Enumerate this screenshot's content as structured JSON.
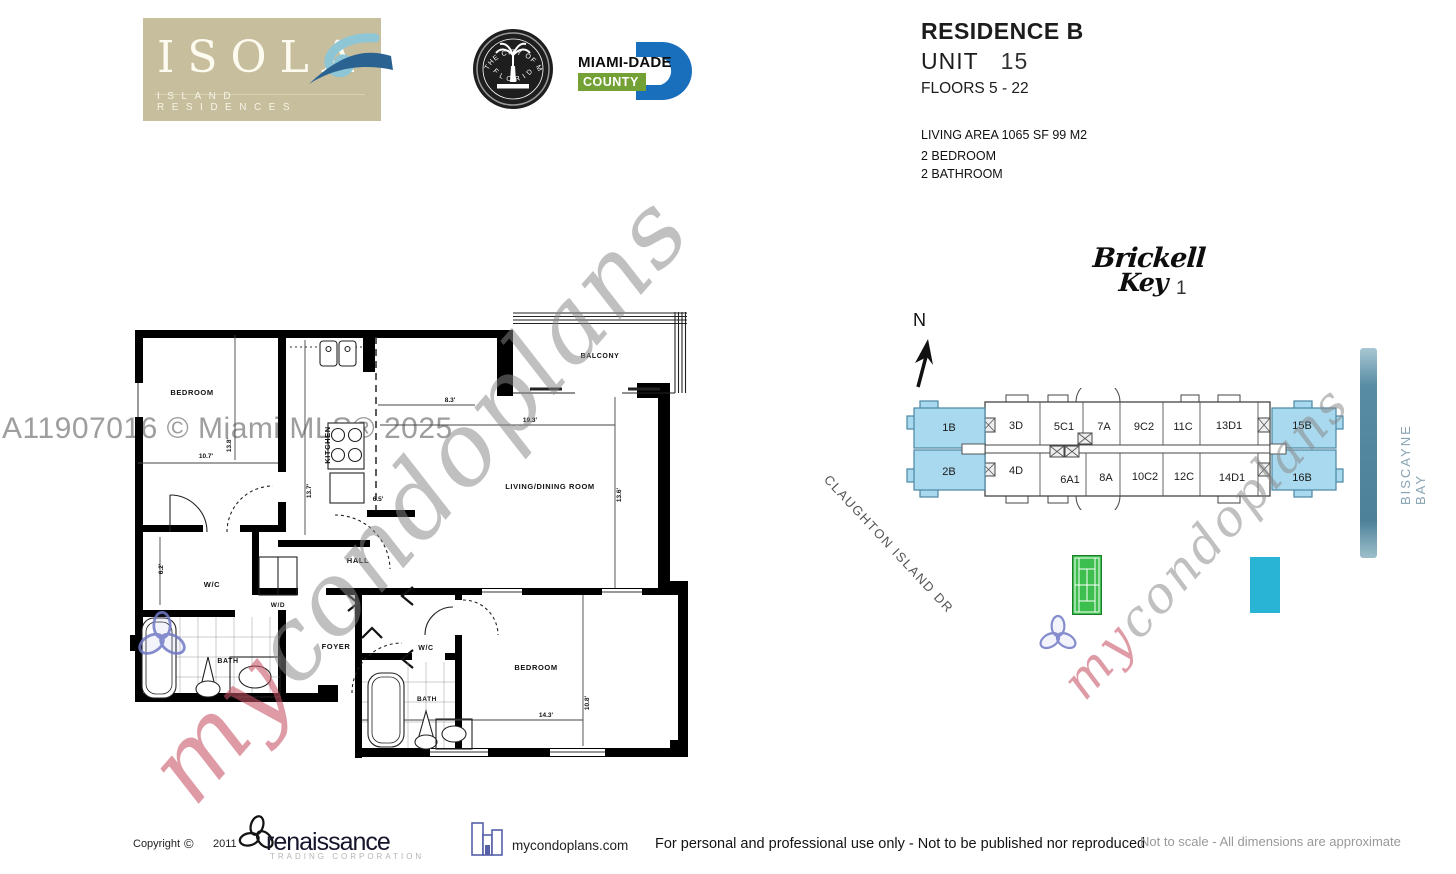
{
  "header": {
    "isola": {
      "name": "ISOLA",
      "subtitle": "ISLAND RESIDENCES"
    },
    "seal": {
      "top": "THE CITY OF MIAMI",
      "bottom": "FLORIDA"
    },
    "county": {
      "name": "MIAMI-DADE",
      "sub": "COUNTY"
    }
  },
  "title_block": {
    "residence": "RESIDENCE B",
    "unit_label": "UNIT",
    "unit_number": "15",
    "floors": "FLOORS 5 - 22",
    "living_area": "LIVING AREA 1065 SF 99 M2",
    "bedrooms": "2 BEDROOM",
    "bathrooms": "2 BATHROOM"
  },
  "brickell": {
    "line1": "Brickell",
    "line2": "Key",
    "number": "1"
  },
  "site_plan": {
    "north": "N",
    "street": "CLAUGHTON ISLAND DR",
    "bay": "BISCAYNE BAY",
    "units_top": [
      "1B",
      "3D",
      "5C1",
      "7A",
      "9C2",
      "11C",
      "13D1",
      "15B"
    ],
    "units_bottom": [
      "2B",
      "4D",
      "6A1",
      "8A",
      "10C2",
      "12C",
      "14D1",
      "16B"
    ],
    "highlight_color": "#a9d9ee",
    "tennis_color": "#3cbf4e",
    "pool_color": "#29b4d6"
  },
  "floor_plan": {
    "rooms": {
      "bedroom1": "BEDROOM",
      "kitchen": "KITCHEN",
      "living": "LIVING/DINING ROOM",
      "balcony": "BALCONY",
      "hall": "HALL",
      "wc1": "W/C",
      "wd": "W/D",
      "bath1": "BATH",
      "foyer": "FOYER",
      "wc2": "W/C",
      "bath2": "BATH",
      "bedroom2": "BEDROOM"
    },
    "dims": {
      "bed1_w": "10.7'",
      "bed1_h": "13.8'",
      "kitchen_h": "13.7'",
      "kitchen_w": "6.5'",
      "balcony_door": "8.3'",
      "living_w": "19.3'",
      "living_h": "13.6'",
      "wc1_h": "6.2'",
      "bed2_w": "14.3'",
      "bed2_h": "10.8'"
    }
  },
  "watermarks": {
    "mls": "A11907016 © Miami MLS® 2025",
    "script_my": "my",
    "script_rest": "condoplans"
  },
  "footer": {
    "copyright": "Copyright",
    "symbol": "©",
    "year": "2011",
    "renaissance": "renaissance",
    "renaissance_sub": "TRADING CORPORATION",
    "site": "mycondoplans.com",
    "notice": "For personal and professional use only - Not to be published nor reproduced",
    "disclaimer": "Not to scale - All dimensions are approximate"
  }
}
